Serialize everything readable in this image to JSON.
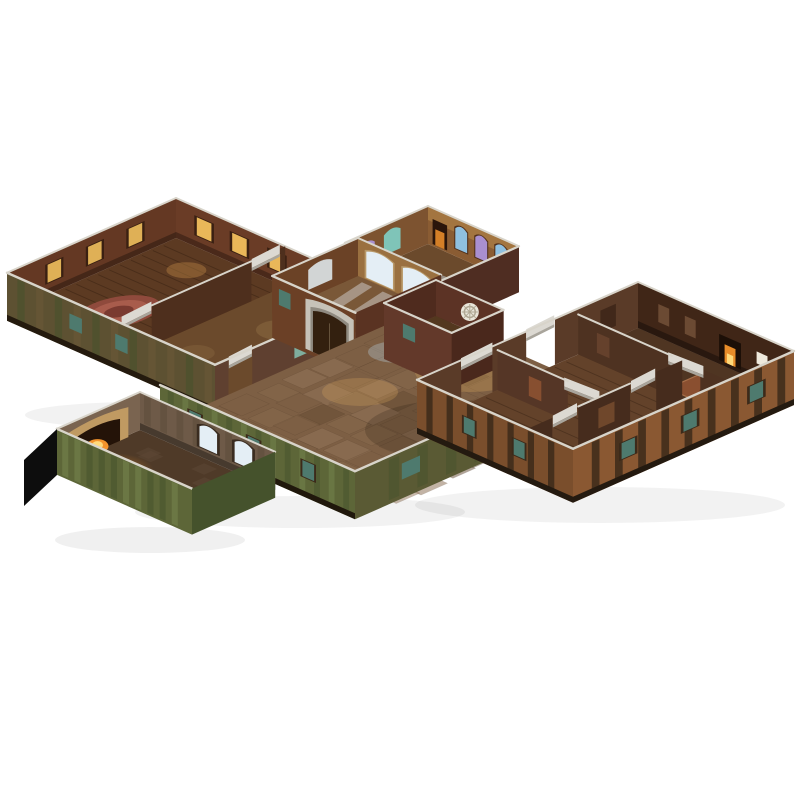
{
  "meta": {
    "title": "Modular papercraft dungeon terrain set",
    "description": "Isometric product photo of an open-top modular cardboard tavern/dungeon terrain set (connected room boxes with printed floors and walls) on a plain white background",
    "background": "#ffffff"
  },
  "palette": {
    "paperEdge": "#d8d4ca",
    "lintel": "#dcd9d2",
    "lintelShade": "#a9a59c",
    "wallRed": "#6a3c26",
    "wallRedDark": "#4e2f1d",
    "wallBrown": "#5a3b28",
    "wallDeep": "#402617",
    "floorWoodDark": "#5c3a22",
    "floorWood": "#6b4a2c",
    "floorWoodMid": "#6f4c2e",
    "floorFireRoom": "#4f3522",
    "cobble": "#7d5f44",
    "cobbleLight": "#93755a",
    "cobbleDark": "#664c34",
    "cobbleWarm": "#876a4d",
    "mossWall": "#5d6638",
    "mossLight": "#76854e",
    "mossDark": "#45522c",
    "mossBrown": "#5d5132",
    "timber": "#3c2a1a",
    "tudorPanel": "#8a5832",
    "tealGlass": "#4e7a6e",
    "tealGlow": "#7fae9e",
    "litWindow": "#f2c05e",
    "litGlowFloor": "#c08a46",
    "stainedBlue": "#8fc0e0",
    "stainedPurple": "#a98fd0",
    "stainedTeal": "#7fc4b8",
    "paleLight": "#e4eef5",
    "stoneArch": "#c6c2b8",
    "stoneArchShade": "#8f8a80",
    "doorDark": "#33200f",
    "chapelWall": "#8a5c33",
    "chapelLight": "#c99a55",
    "brightWall": "#9a7040",
    "brightFloor": "#7a5838",
    "annexWall": "#5c3325",
    "annexFloor": "#53381f",
    "kitchenWall": "#6e5a48",
    "kitchenFloor": "#4f3a28",
    "hearthStone": "#c09a62",
    "fire": "#ff9a2e",
    "fireCore": "#ffd97a",
    "rugRed": "#8f4a3c",
    "rugLight": "#a85c4c",
    "rugDark": "#7a3a30",
    "rugOrange": "#8a4f30",
    "rugPink": "#93564c",
    "black": "#0d0d0d"
  },
  "modules": [
    {
      "id": "guest-rooms",
      "name": "module-guest-rooms",
      "rooms": [
        "bedroom with round rug",
        "plain side room"
      ]
    },
    {
      "id": "chapel",
      "name": "module-chapel",
      "rooms": [
        "stained glass chapel"
      ]
    },
    {
      "id": "bright-room",
      "name": "module-bright-room",
      "rooms": [
        "sunlit room with arched windows and stone arch door"
      ]
    },
    {
      "id": "annex",
      "name": "module-annex",
      "rooms": [
        "small annex with rose window"
      ]
    },
    {
      "id": "great-hall",
      "name": "module-great-hall",
      "rooms": [
        "cobblestone great hall"
      ]
    },
    {
      "id": "kitchen",
      "name": "module-kitchen",
      "rooms": [
        "kitchen with stone hearth and fire"
      ]
    },
    {
      "id": "lodging-wing",
      "name": "module-lodging-wing",
      "rooms": [
        "fireplace room",
        "two bedrooms",
        "rug corridor"
      ]
    }
  ],
  "features": [
    "lit-window",
    "stained-glass-window",
    "rose-window",
    "arch-door",
    "hearth-fire",
    "fireplace",
    "rug",
    "door-lintel",
    "mossy-exterior-wall",
    "timber-frame-exterior",
    "unprinted-black-side"
  ]
}
